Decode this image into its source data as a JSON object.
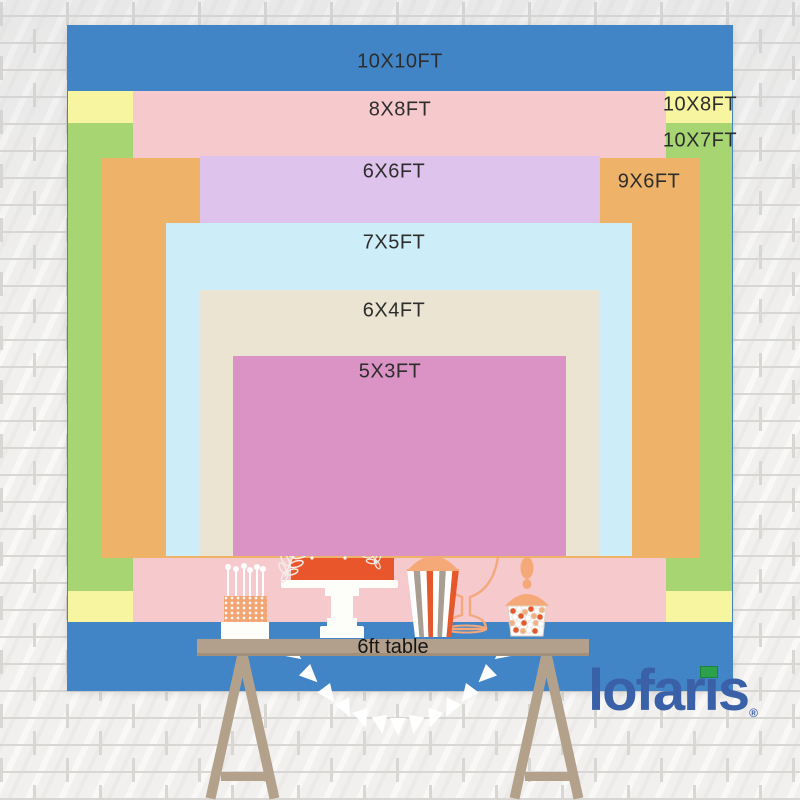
{
  "size_chart": {
    "title_concept": "backdrop size comparison chart",
    "sizes": [
      {
        "id": "10x10",
        "label": "10X10FT",
        "width_ft": 10,
        "height_ft": 10,
        "color": "#4185c6"
      },
      {
        "id": "8x8",
        "label": "8X8FT",
        "width_ft": 8,
        "height_ft": 8,
        "color": "#f6c9cd"
      },
      {
        "id": "10x8",
        "label": "10X8FT",
        "width_ft": 10,
        "height_ft": 8,
        "color": "#f8f5a1"
      },
      {
        "id": "10x7",
        "label": "10X7FT",
        "width_ft": 10,
        "height_ft": 7,
        "color": "#a6d572"
      },
      {
        "id": "6x6",
        "label": "6X6FT",
        "width_ft": 6,
        "height_ft": 6,
        "color": "#dec4ec"
      },
      {
        "id": "9x6",
        "label": "9X6FT",
        "width_ft": 9,
        "height_ft": 6,
        "color": "#eeb368"
      },
      {
        "id": "7x5",
        "label": "7X5FT",
        "width_ft": 7,
        "height_ft": 5,
        "color": "#cdeef8"
      },
      {
        "id": "6x4",
        "label": "6X4FT",
        "width_ft": 6,
        "height_ft": 4,
        "color": "#ebe4d3"
      },
      {
        "id": "5x3",
        "label": "5X3FT",
        "width_ft": 5,
        "height_ft": 3,
        "color": "#db92c4"
      }
    ],
    "table_label": "6ft table"
  },
  "brand": {
    "logo_text": "lofaris",
    "registered_mark": "®",
    "logo_color": "#3a61a8",
    "logo_accent_color": "#2ca04a"
  },
  "decorations": {
    "items": [
      "tiered-wedding-cake",
      "cake-stand",
      "white-line-flowers",
      "white-line-birds",
      "mini-cake-with-candles",
      "striped-popcorn-jar",
      "candy-jar",
      "apothecary-jar-outline",
      "pennant-garland",
      "trestle-dessert-table",
      "white-brick-wall"
    ]
  }
}
